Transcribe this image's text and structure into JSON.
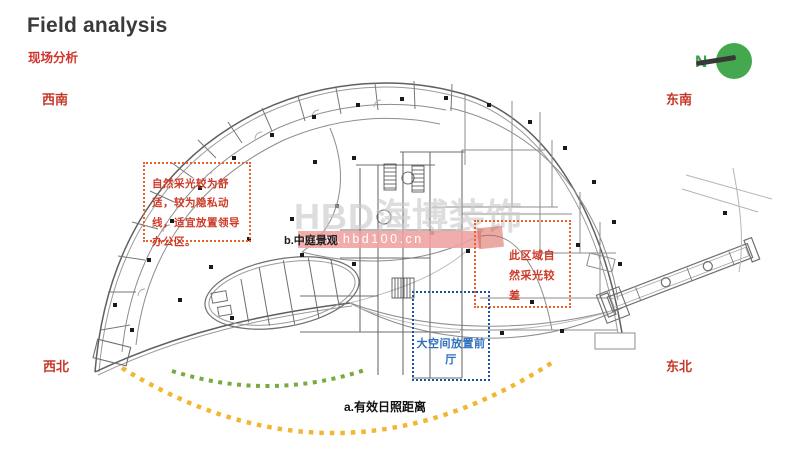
{
  "header": {
    "title": "Field analysis",
    "subtitle": "现场分析"
  },
  "compass": {
    "label": "N"
  },
  "directions": {
    "top_left": "西南",
    "top_right": "东南",
    "bottom_left": "西北",
    "bottom_right": "东北"
  },
  "annotations": {
    "left_note": "自然采光较为舒适，较为隐私动线，适宜放置领导办公区。",
    "right_note": "此区域自然采光较差",
    "blue_note": "大空间放置前厅",
    "atrium_label": "b.中庭景观",
    "sunshine_label": "a.有效日照距离"
  },
  "watermark": {
    "brand": "HBD海博装饰",
    "url": "www.hbd100.cn"
  },
  "colors": {
    "subtitle_red": "#d0342c",
    "direction_red": "#c53727",
    "note_red": "#cf3a28",
    "box_orange": "#e8622a",
    "box_blue": "#2050a0",
    "blue_text": "#2e6fc0",
    "green_arc": "#76ab3f",
    "yellow_arc": "#f2b632",
    "compass_green": "#44a94e",
    "needle_dark": "#383838"
  }
}
